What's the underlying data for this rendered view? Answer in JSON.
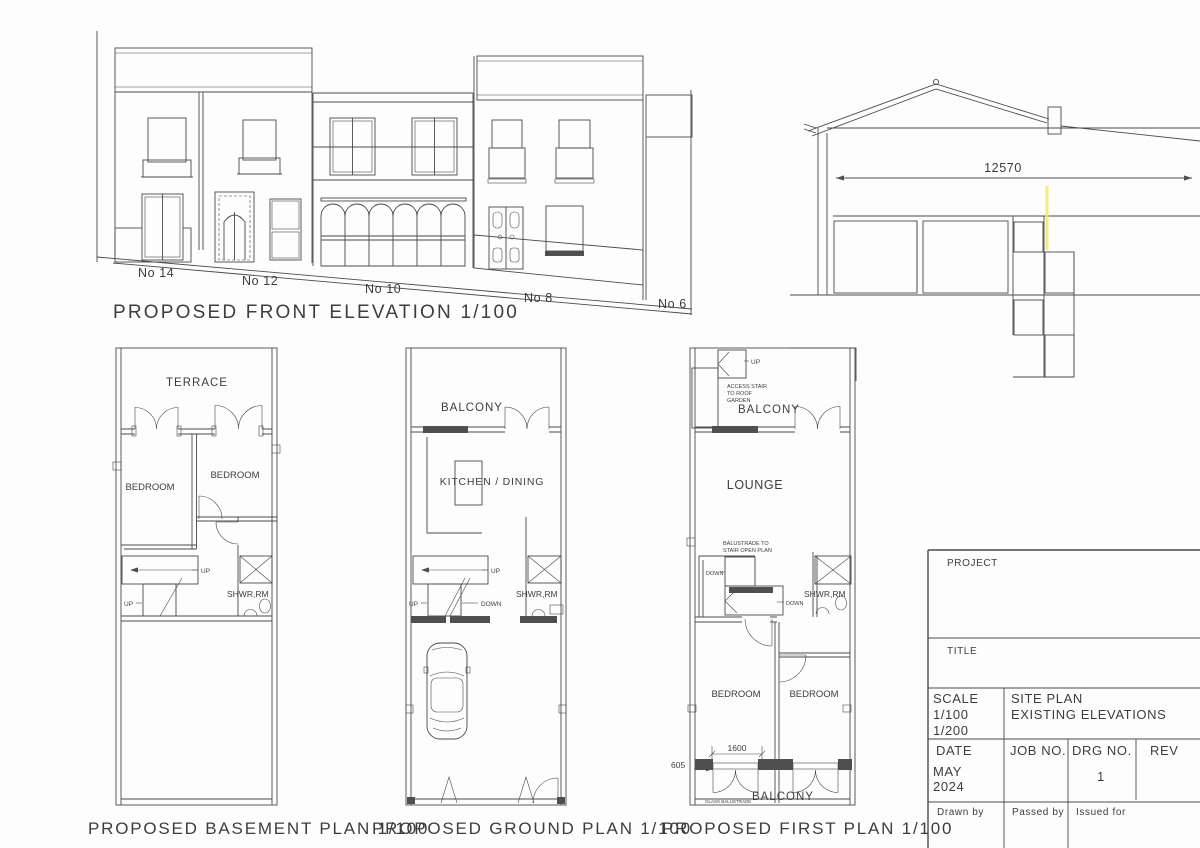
{
  "colors": {
    "line": "#4a4a4a",
    "highlight": "#efe86e"
  },
  "elevation": {
    "title": "PROPOSED FRONT ELEVATION 1/100",
    "h14": "No 14",
    "h12": "No 12",
    "h10": "No 10",
    "h8": "No 8",
    "h6": "No 6"
  },
  "section": {
    "dim": "12570"
  },
  "basement": {
    "caption": "PROPOSED BASEMENT PLAN 1/100",
    "terrace": "TERRACE",
    "bed1": "BEDROOM",
    "bed2": "BEDROOM",
    "shwr": "SHWR,RM",
    "up1": "UP",
    "up2": "UP"
  },
  "ground": {
    "caption": "PROPOSED GROUND PLAN 1/100",
    "balcony": "BALCONY",
    "kitchen": "KITCHEN / DINING",
    "shwr": "SHWR,RM",
    "up1": "UP",
    "up2": "UP",
    "down": "DOWN"
  },
  "first": {
    "caption": "PROPOSED FIRST PLAN 1/100",
    "up": "UP",
    "acc1": "ACCESS STAIR",
    "acc2": "TO ROOF",
    "acc3": "GARDEN",
    "balcony_top": "BALCONY",
    "lounge": "LOUNGE",
    "bal1": "BALUSTRADE TO",
    "bal2": "STAIR OPEN PLAN",
    "down1": "DOWN",
    "down2": "DOWN",
    "shwr": "SHWR,RM",
    "bed1": "BEDROOM",
    "bed2": "BEDROOM",
    "dim1600": "1600",
    "dim605": "605",
    "balcony_bottom": "BALCONY",
    "glass": "GLASS BALUSTRADE"
  },
  "titleblock": {
    "project": "PROJECT",
    "title": "TITLE",
    "scale_label": "SCALE",
    "scale1": "1/100",
    "scale2": "1/200",
    "sheet1": "SITE PLAN",
    "sheet2": "EXISTING ELEVATIONS",
    "date_label": "DATE",
    "month": "MAY",
    "year": "2024",
    "job": "JOB NO.",
    "drg": "DRG NO.",
    "drg_no": "1",
    "rev": "REV",
    "drawn": "Drawn by",
    "passed": "Passed by",
    "issued": "Issued for"
  }
}
